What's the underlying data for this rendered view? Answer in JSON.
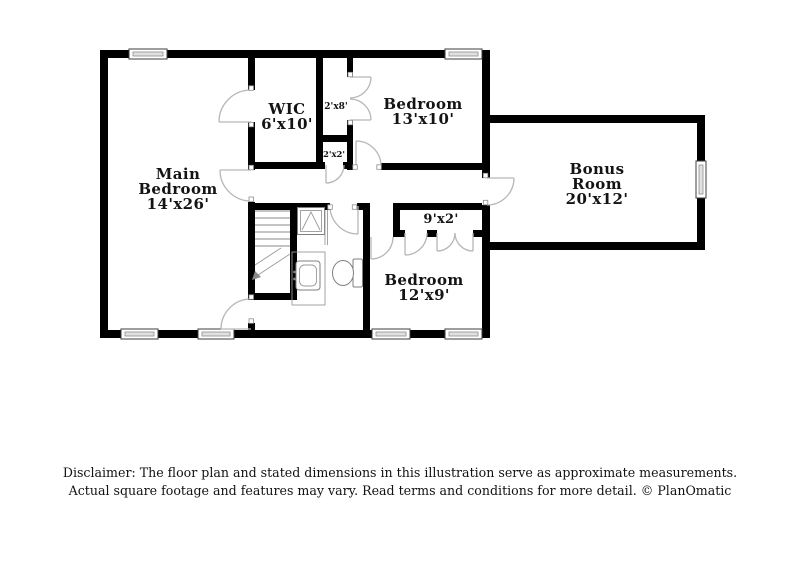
{
  "floor_plan": {
    "rooms": {
      "main_bedroom": {
        "line1": "Main",
        "line2": "Bedroom",
        "dims": "14'x26'"
      },
      "wic": {
        "line1": "WIC",
        "dims": "6'x10'"
      },
      "bedroom_13x10": {
        "line1": "Bedroom",
        "dims": "13'x10'"
      },
      "bonus_room": {
        "line1": "Bonus",
        "line2": "Room",
        "dims": "20'x12'"
      },
      "bedroom_12x9": {
        "line1": "Bedroom",
        "dims": "12'x9'"
      },
      "closet_2x8": {
        "dims": "2'x8'"
      },
      "closet_2x2": {
        "dims": "2'x2'"
      },
      "closet_9x2": {
        "dims": "9'x2'"
      }
    },
    "fixtures": [
      "staircase",
      "shower",
      "sink-vanity",
      "toilet"
    ],
    "window_count": 7,
    "colors": {
      "wall": "#000000",
      "background": "#ffffff",
      "label_text": "#141414",
      "door_arc": "#b6b6b6",
      "window_fill": "#e0e0e0",
      "fixture_line": "#9a9a9a"
    }
  },
  "disclaimer": {
    "line1": "Disclaimer: The floor plan and stated dimensions in this illustration serve as approximate measurements.",
    "line2": "Actual square footage and features may vary. Read terms and conditions for more detail. © PlanOmatic"
  }
}
